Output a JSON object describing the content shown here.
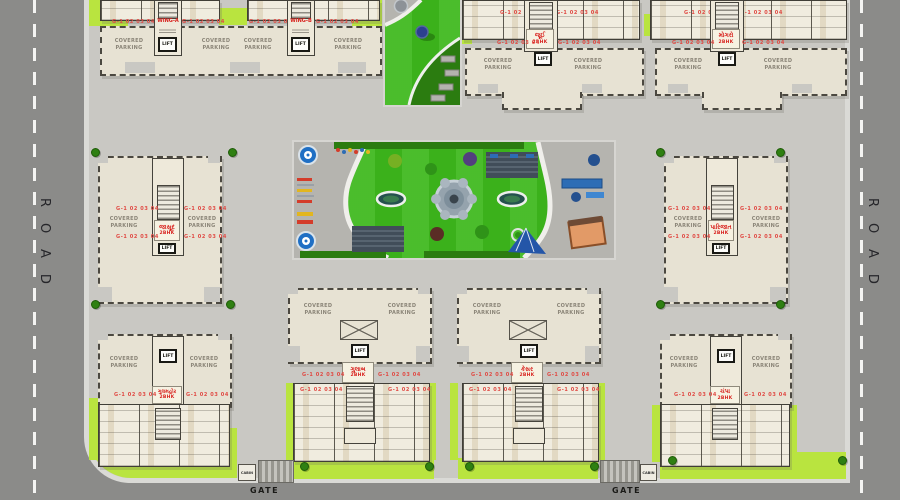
{
  "plan": {
    "roads": {
      "left": "ROAD",
      "right": "ROAD"
    },
    "gates": {
      "label": "GATE",
      "cabin": "CABIN"
    },
    "shared": {
      "lift": "LIFT",
      "covered_parking": "COVERED\nPARKING",
      "unit_numbers": "G-1 02 03 04",
      "bhk": "2BHK"
    },
    "buildings": {
      "wing_a": "WING-A",
      "wing_b": "WING-B",
      "top_middle": "જૂઈ",
      "top_right": "મોગરો",
      "left_middle": "જાસૂદ",
      "right_middle": "પારિજાત",
      "bottom_left": "ગુલમહોર",
      "bottom_middle_left": "ગુલાબ",
      "bottom_middle_right": "કેસર",
      "bottom_right": "ચંપા"
    },
    "colors": {
      "road": "#8b8b89",
      "ground": "#c9c8c3",
      "lawn_green": "#3db81c",
      "lime_green": "#b9e43f",
      "building_cream": "#e7e2d3",
      "accent_red": "#d81f1b"
    }
  }
}
